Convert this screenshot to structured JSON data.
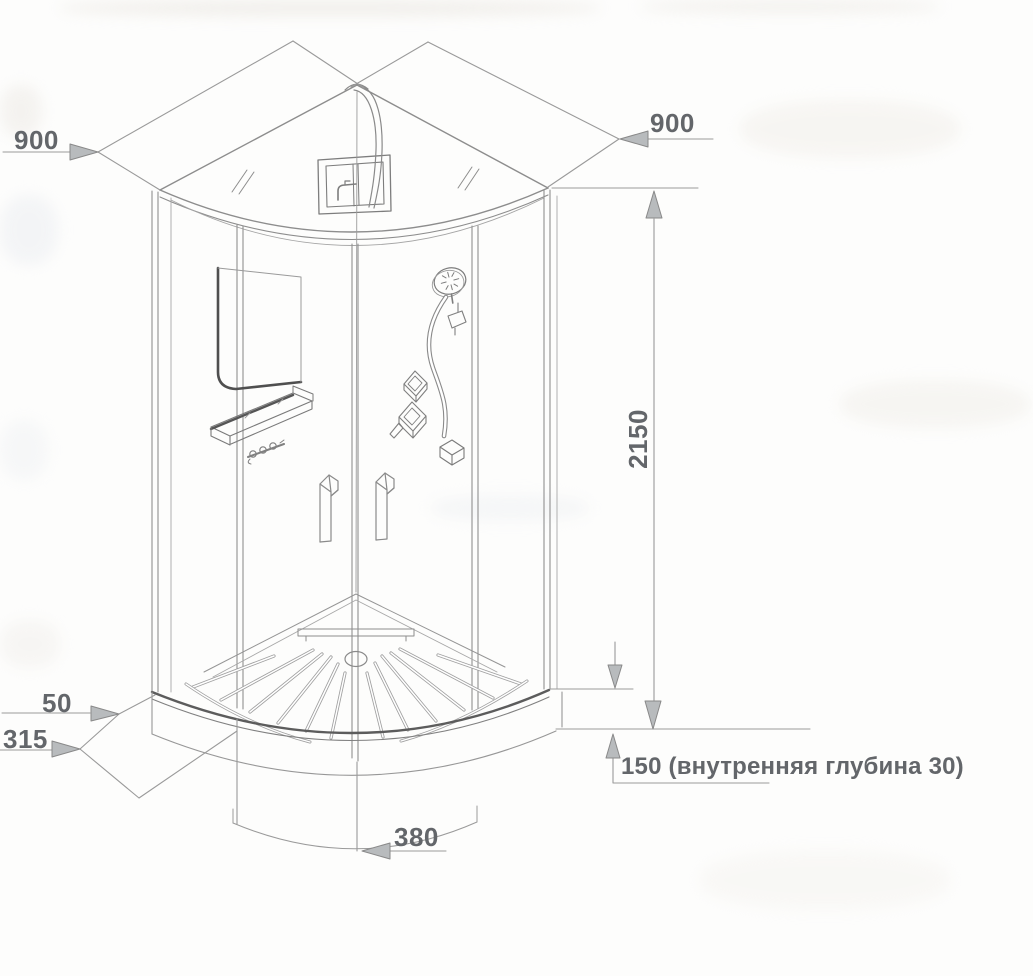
{
  "diagram": {
    "type": "technical-drawing",
    "subject": "corner-shower-cabin-isometric-view",
    "labels": {
      "left_width": "900",
      "right_width": "900",
      "total_height": "2150",
      "tray_rim": "50",
      "tray_front_offset": "315",
      "door_center_offset": "380",
      "tray_height_note": "150 (внутренняя глубина 30)"
    },
    "colors": {
      "line": "#8d8d8d",
      "dark_line": "#5c5c5c",
      "dimension_line": "#9a9a9a",
      "arrow_fill": "#b8bbbd",
      "arrow_stroke": "#898989",
      "text": "#63666a",
      "background": "#fdfdfc"
    },
    "icons": [
      "shower-head-icon",
      "hand-shower-hose-icon",
      "mixer-valve-icon",
      "drain-icon"
    ]
  }
}
